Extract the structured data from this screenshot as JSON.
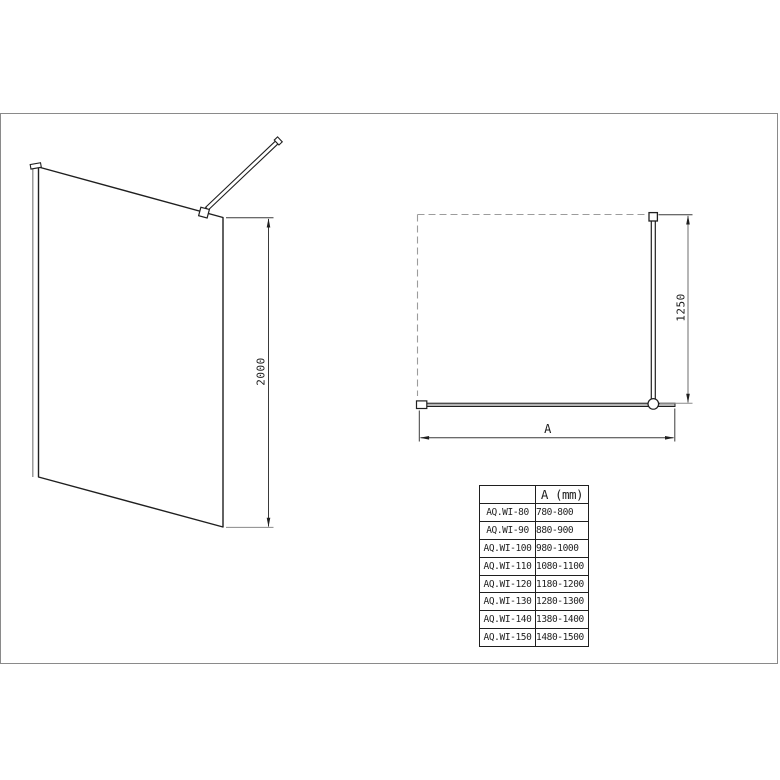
{
  "colors": {
    "line": "#2a2a2a",
    "muted_line": "#8a8a8a",
    "dashed_line": "#9c9c9c",
    "frame_border": "#8a8a8a",
    "glass_fill_top_view": "#b5b5b5",
    "background": "#ffffff"
  },
  "side_view": {
    "height_dim": "2000"
  },
  "top_view": {
    "bar_dim": "1250",
    "width_dim": "A"
  },
  "size_table": {
    "header": {
      "model": "",
      "width": "A (mm)"
    },
    "rows": [
      {
        "model": "AQ.WI-80",
        "width_range": "780-800"
      },
      {
        "model": "AQ.WI-90",
        "width_range": "880-900"
      },
      {
        "model": "AQ.WI-100",
        "width_range": "980-1000"
      },
      {
        "model": "AQ.WI-110",
        "width_range": "1080-1100"
      },
      {
        "model": "AQ.WI-120",
        "width_range": "1180-1200"
      },
      {
        "model": "AQ.WI-130",
        "width_range": "1280-1300"
      },
      {
        "model": "AQ.WI-140",
        "width_range": "1380-1400"
      },
      {
        "model": "AQ.WI-150",
        "width_range": "1480-1500"
      }
    ]
  }
}
